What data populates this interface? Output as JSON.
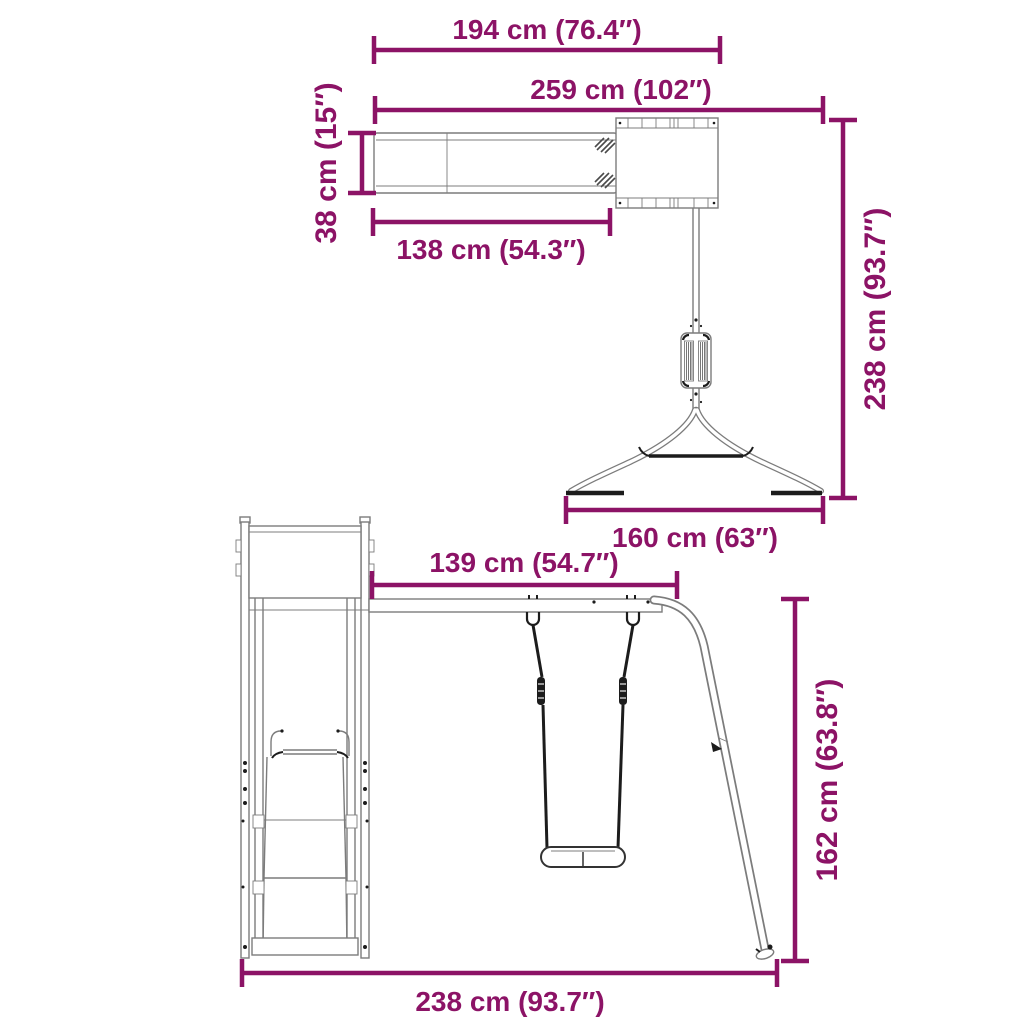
{
  "colors": {
    "dimension": "#8c1366",
    "outline": "#7c7c7c",
    "detail": "#1c1c1c",
    "background": "#ffffff"
  },
  "diagram": {
    "type": "product-dimension-drawing",
    "views": [
      "top-view-playset",
      "front-view-playset"
    ]
  },
  "dims": {
    "d194": "194 cm (76.4″)",
    "d259": "259 cm (102″)",
    "d38": "38 cm (15″)",
    "d138": "138 cm (54.3″)",
    "d238_top": "238 cm (93.7″)",
    "d160": "160 cm (63″)",
    "d139": "139 cm (54.7″)",
    "d162": "162 cm (63.8″)",
    "d238_bottom": "238 cm (93.7″)"
  }
}
